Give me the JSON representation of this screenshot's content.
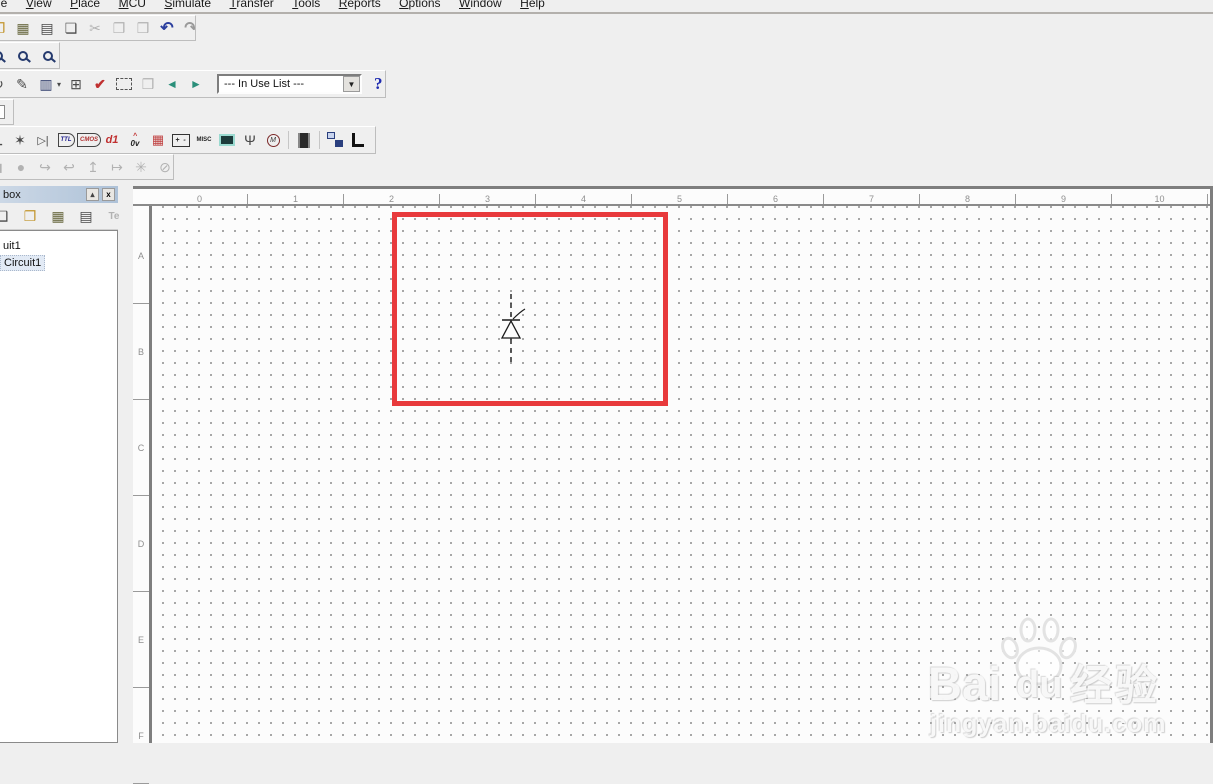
{
  "menu": {
    "items": [
      "File",
      "View",
      "Place",
      "MCU",
      "Simulate",
      "Transfer",
      "Tools",
      "Reports",
      "Options",
      "Window",
      "Help"
    ]
  },
  "toolbars": {
    "standard": {
      "open": "❐",
      "save": "▦",
      "print": "▤",
      "print_preview": "❏",
      "cut": "✂",
      "copy": "❐",
      "paste": "❒",
      "undo": "↶",
      "redo": "↷"
    },
    "main": {
      "rotate": "↻",
      "component_wizard": "✎",
      "grapher": "▥",
      "grapher_caret": "▾",
      "postprocessor": "⊞",
      "erc_check": "✔",
      "back_annotate": "❒",
      "back_arrow": "◄",
      "forward_arrow": "►",
      "in_use_list": "--- In Use List ---",
      "combo_caret": "▼",
      "help": "?"
    },
    "components": {
      "source": "⊥",
      "transistor": "✶",
      "diode": "▷|",
      "ttl_label": "TTL",
      "cmos_label": "CMOS",
      "misc_digital": "d1",
      "indicator_caret": "^",
      "indicator_label": "0v",
      "segment": "▦",
      "battery_label": "+ -",
      "misc_label": "MISC",
      "rf": "Ψ",
      "motor_label": "M"
    },
    "simulation": {
      "square": "◼",
      "dot": "●",
      "step_into": "↪",
      "step_over": "↩",
      "step_out": "↥",
      "run_to": "↦",
      "pause": "✳",
      "stop": "⊘"
    }
  },
  "design_toolbox": {
    "title": "box",
    "restore_glyph": "▴",
    "close_glyph": "x",
    "icons": {
      "new_doc": "❑",
      "open": "❐",
      "save": "▦",
      "doc_arrow": "▤",
      "te": "Te"
    },
    "tree": {
      "item1": "uit1",
      "item2": "Circuit1"
    }
  },
  "canvas": {
    "h_ruler": [
      "0",
      "1",
      "2",
      "3",
      "4",
      "5",
      "6",
      "7",
      "8",
      "9",
      "10"
    ],
    "v_ruler": [
      "A",
      "B",
      "C",
      "D",
      "E",
      "F"
    ],
    "highlight_color": "#e83a3c",
    "placed_component": "diode-ghost"
  },
  "watermark": {
    "brand_left": "Bai",
    "brand_right": "du",
    "cn": "经验",
    "url": "jingyan.baidu.com"
  }
}
